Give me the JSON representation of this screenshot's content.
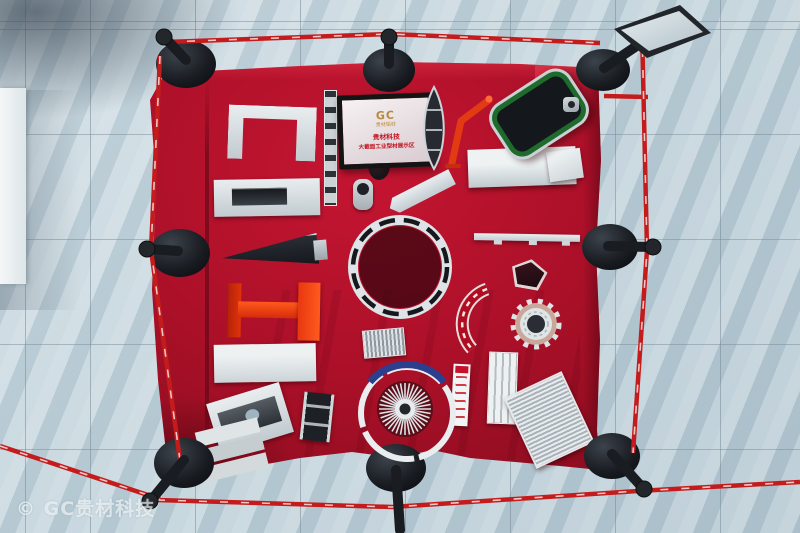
{
  "scene": {
    "subject": "top-down view of red velvet display table with aluminum extrusion profiles, enclosed by black stanchions and red barrier tape on marble floor",
    "stanchion_count": 8
  },
  "sign": {
    "logo": "GC",
    "logo_sub": "贵材铝材",
    "line1": "贵材科技",
    "line2": "大截面工业型材展示区"
  },
  "watermark": {
    "text": "© GC贵材科技"
  },
  "colors": {
    "floor_tile": "#bfd0d9",
    "floor_grout": "#8498a4",
    "floor_dark_corner": "#5a6c78",
    "white_panel": "#eef2f3",
    "table_red": "#ab1028",
    "table_red_bright": "#c51532",
    "table_red_deep": "#700a1b",
    "barrier_tape_red": "#c41c1c",
    "stanchion_black": "#191c20",
    "aluminum_light": "#d8dee1",
    "aluminum_shadow": "#9aa4ab",
    "profile_dark": "#23272d",
    "profile_orange": "#e8390f",
    "profile_green": "#1e6b2d",
    "fan_band_blue": "#2c3e8e",
    "sign_frame_black": "#141414",
    "sign_logo_gold": "#b8893a",
    "sign_text_red": "#c01420"
  },
  "display_items": [
    "u-channel-profile",
    "slotted-ladder-strip",
    "info-placard",
    "boat-shaped-profile",
    "orange-angle-arm",
    "green-frame-profile",
    "hex-connector-nut",
    "gray-slab-profile",
    "small-white-box",
    "handle-plate-profile",
    "round-socket-profile",
    "angled-wedge-bar",
    "dark-taper-profile",
    "orange-i-beam",
    "slotted-ring-profile",
    "thin-shelf-bar",
    "pentagon-profile",
    "curved-arc-segment",
    "gear-ring-profile",
    "small-heatsink-block",
    "flat-bar-profile",
    "sill-panel-profile",
    "dark-channel-wedge",
    "labeled-strip-profile",
    "grooved-channel-bar",
    "finned-heatsink-plate",
    "stacked-plates",
    "fan-heatsink-ring"
  ]
}
